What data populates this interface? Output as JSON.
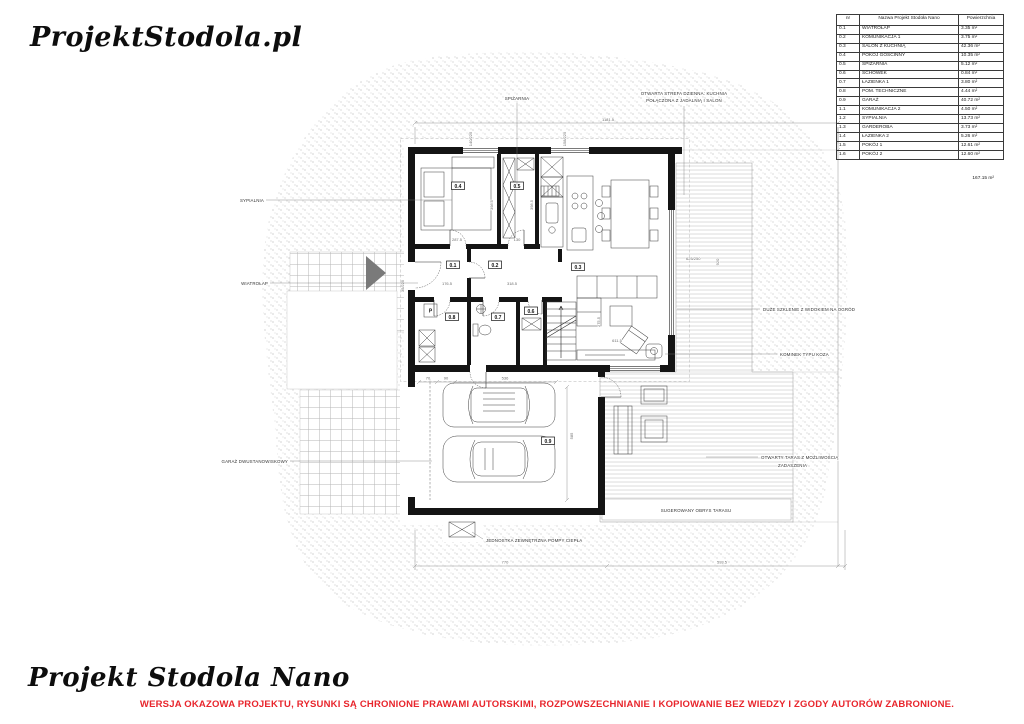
{
  "logo": {
    "text": "ProjektStodola.pl"
  },
  "room_table": {
    "headers": [
      "nr",
      "Nazwa Projekt Stodoła Nano",
      "Powierzchnia"
    ],
    "rows": [
      [
        "0.1",
        "WIATROŁAP",
        "3.35 m²"
      ],
      [
        "0.2",
        "KOMUNIKACJA 1",
        "3.75 m²"
      ],
      [
        "0.3",
        "SALON Z KUCHNIĄ",
        "42.36 m²"
      ],
      [
        "0.4",
        "POKÓJ GOŚCINNY",
        "10.35 m²"
      ],
      [
        "0.5",
        "SPIŻARNIA",
        "5.12 m²"
      ],
      [
        "0.6",
        "SCHOWEK",
        "0.84 m²"
      ],
      [
        "0.7",
        "ŁAZIENKA 1",
        "3.80 m²"
      ],
      [
        "0.8",
        "POM. TECHNICZNE",
        "4.44 m²"
      ],
      [
        "0.9",
        "GARAŻ",
        "40.72 m²"
      ],
      [
        "1.1",
        "KOMUNIKACJA 2",
        "4.50 m²"
      ],
      [
        "1.2",
        "SYPIALNIA",
        "13.73 m²"
      ],
      [
        "1.3",
        "GARDEROBA",
        "3.73 m²"
      ],
      [
        "1.4",
        "ŁAZIENKA 2",
        "5.26 m²"
      ],
      [
        "1.5",
        "POKÓJ 1",
        "12.61 m²"
      ],
      [
        "1.6",
        "POKÓJ 2",
        "12.60 m²"
      ]
    ],
    "total": "167.15 m²"
  },
  "plan": {
    "room_numbers": {
      "r01": "0.1",
      "r02": "0.2",
      "r03": "0.3",
      "r04": "0.4",
      "r05": "0.5",
      "r06": "0.6",
      "r07": "0.7",
      "r08": "0.8",
      "r09": "0.9"
    },
    "equipment": {
      "boiler": "P"
    },
    "callouts": {
      "sypialnia": "SYPIALNIA",
      "wiatrolap": "WIATROŁAP",
      "garaz": "GARAŻ DWUSTANOWISKOWY",
      "spizarnia": "SPIŻARNIA",
      "strefa1": "OTWARTA STREFA DZIENNA: KUCHNIA",
      "strefa2": "POŁĄCZONA Z JADALNIĄ I SALON",
      "szklenie": "DUŻE SZKLENIE Z WIDOKIEM NA OGRÓD",
      "kominek": "KOMINEK TYPU KOZA",
      "taras1": "OTWARTY TARAS Z MOŻLIWOŚCIĄ",
      "taras2": "ZADASZENIA",
      "pompa": "JEDNOSTKA ZEWNĘTRZNA POMPY CIEPŁA",
      "obrys": "SUGEROWANY OBRYS TARASU"
    },
    "dims": {
      "total_width": "1181.5",
      "win_a": "140/225",
      "win_b": "158/225",
      "door_entry": "35/225",
      "win_glazing": "625/250",
      "terrace_len": "920",
      "g70": "70",
      "g90": "90",
      "g536": "536",
      "g585": "585",
      "b770": "770",
      "b5935": "593.5",
      "r287": "287.5",
      "r398": "398.5",
      "r130": "130",
      "r176": "176.5",
      "r318": "318.5",
      "r611": "611.5",
      "r275": "275.5"
    }
  },
  "footer": {
    "logo_text": "Projekt Stodola Nano",
    "warning": "WERSJA OKAZOWA PROJEKTU, RYSUNKI  SĄ CHRONIONE PRAWAMI AUTORSKIMI, ROZPOWSZECHNIANIE I KOPIOWANIE BEZ WIEDZY I ZGODY AUTORÓW ZABRONIONE.",
    "warning_color": "#e8252c"
  }
}
